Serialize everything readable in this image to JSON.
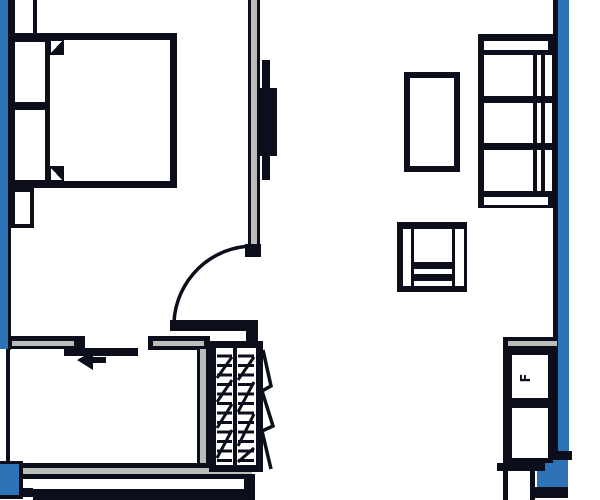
{
  "plan": {
    "kind": "apartment-floor-plan",
    "labels": {
      "fridge": "F"
    },
    "stairs": {
      "tread_count": 12
    },
    "colors": {
      "accent_blue": "#2e73b8",
      "line_dark": "#0d0e1c",
      "wall_core": "#b9beba",
      "background": "#ffffff"
    }
  }
}
